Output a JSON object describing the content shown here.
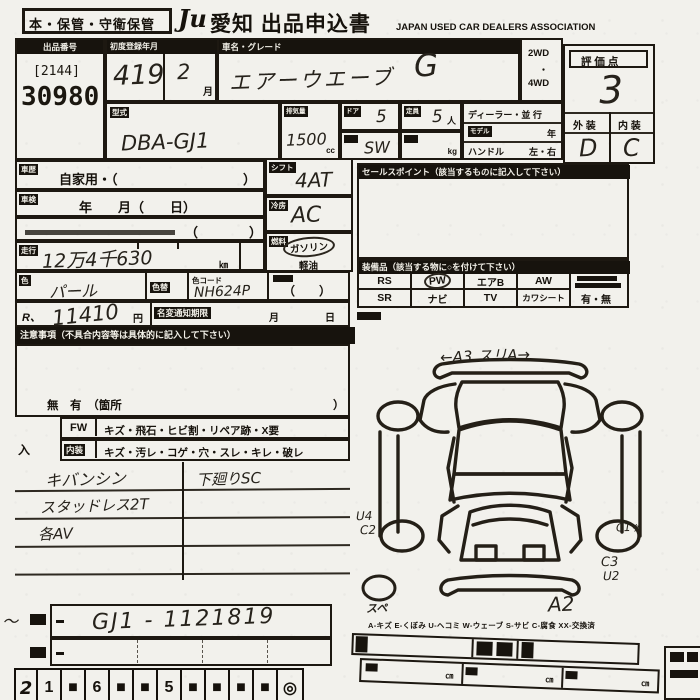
{
  "header": {
    "storage": "本・保管・守衛保管",
    "logo": "Ju",
    "title": "愛知 出品申込書",
    "association": "JAPAN USED CAR DEALERS ASSOCIATION"
  },
  "top": {
    "lot_label": "出品番号",
    "lot_bracket": "[2144]",
    "lot_number": "30980",
    "reg_label": "初度登録年月",
    "reg_value": "419",
    "reg_month_value": "2",
    "reg_month_unit": "月",
    "name_label": "車名・グレード",
    "name_value": "エアーウエーブ",
    "grade_value": "G",
    "drive_line1": "2WD",
    "drive_dot": "・",
    "drive_line2": "4WD",
    "score_label": "評 価 点",
    "score_value": "3",
    "ext_label": "外 装",
    "int_label": "内 装",
    "ext_value": "D",
    "int_value": "C"
  },
  "specs": {
    "model_label": "型式",
    "model_value": "DBA-GJ1",
    "disp_label": "排気量",
    "disp_value": "1500",
    "disp_unit": "cc",
    "door_label": "ドア",
    "door_value": "5",
    "cap_label": "定員",
    "cap_value": "5",
    "cap_unit": "人",
    "body_value": "SW",
    "weight_unit": "kg",
    "dealer_label": "ディーラー・並 行",
    "modelyear_label": "モデル",
    "modelyear_unit": "年",
    "handle_label": "ハンドル",
    "handle_value": "左・右"
  },
  "left": {
    "history_label": "車歴",
    "history_value": "自家用・（",
    "history_close": "）",
    "inspect_label": "車検",
    "inspect_value": "年　　月（　　日）",
    "note_paren_open": "（",
    "note_paren_close": "）",
    "mileage_label": "走行",
    "mileage_value": "12万4千630",
    "mileage_unit": "㎞",
    "color_label": "色",
    "color_value": "パール",
    "color_change_label": "色替",
    "color_code_label": "色コード",
    "color_code_value": "NH624P",
    "color_paren": "（　　）",
    "recycle_label": "R、",
    "recycle_value": "11410",
    "recycle_unit": "円",
    "namechange_label": "名変通知期限",
    "namechange_month": "月",
    "namechange_day": "日",
    "caution_header": "注意事項（不具合内容等は具体的に記入して下さい）",
    "presence_text": "無　有　（箇所",
    "presence_close": "）",
    "fw_label": "FW",
    "fw_text": "キズ・飛石・ヒビ割・リペア跡・X要",
    "int_label": "内装",
    "int_text": "キズ・汚レ・コゲ・穴・スレ・キレ・破レ",
    "enter_mark": "入",
    "note1": "キバンシン",
    "note1r": "下廻りSC",
    "note2": "スタッドレス2T",
    "note3": "各AV"
  },
  "right": {
    "shift_label": "シフト",
    "shift_value": "4AT",
    "cool_label": "冷房",
    "cool_value": "AC",
    "fuel_label": "燃料",
    "fuel_option1": "ガソリン",
    "fuel_option2": "軽油",
    "sales_header": "セールスポイント（該当するものに記入して下さい）",
    "equip_header": "装備品（該当する物に○を付けて下さい）",
    "equip_r1": [
      "RS",
      "PW",
      "エアB",
      "AW"
    ],
    "equip_r2": [
      "SR",
      "ナビ",
      "TV",
      "カワシート"
    ],
    "doc_options": "有・無"
  },
  "diagram": {
    "ann_top": "←A3 スリA→",
    "ann_left1": "U4",
    "ann_left2": "C2",
    "ann_right1": "C1ヶ",
    "ann_right2a": "C3",
    "ann_right2b": "U2",
    "ann_bottom": "A2",
    "ann_spare": "スペ",
    "legend": "A-キズ E-くぼみ U-ヘコミ W-ウェーブ S-サビ C-腐食 XX-交換済"
  },
  "bottom": {
    "squiggle": "〜",
    "chassis_value": "GJ1 - 1121819",
    "cm": "㎝",
    "strip": [
      "2",
      "1",
      "■",
      "6",
      "■",
      "■",
      "5",
      "■",
      "■",
      "■",
      "■",
      "◎"
    ]
  }
}
